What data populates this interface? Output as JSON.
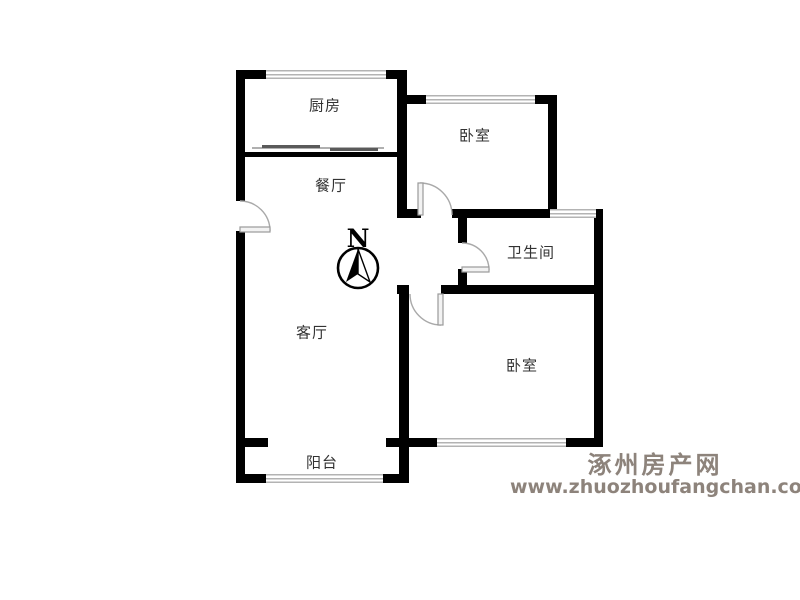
{
  "floorplan": {
    "rooms": [
      {
        "id": "kitchen",
        "label": "厨房"
      },
      {
        "id": "bedroom-top",
        "label": "卧室"
      },
      {
        "id": "dining",
        "label": "餐厅"
      },
      {
        "id": "bathroom",
        "label": "卫生间"
      },
      {
        "id": "living",
        "label": "客厅"
      },
      {
        "id": "bedroom-bottom",
        "label": "卧室"
      },
      {
        "id": "balcony",
        "label": "阳台"
      }
    ],
    "compass": {
      "label": "N"
    },
    "colors": {
      "wall": "#000000",
      "window": "#b3b3b3",
      "door": "#a9a9a9",
      "label_text": "#333333",
      "watermark": "#8d837b"
    }
  },
  "watermark": {
    "site_name": "涿州房产网",
    "site_url": "www.zhuozhoufangchan.com"
  }
}
